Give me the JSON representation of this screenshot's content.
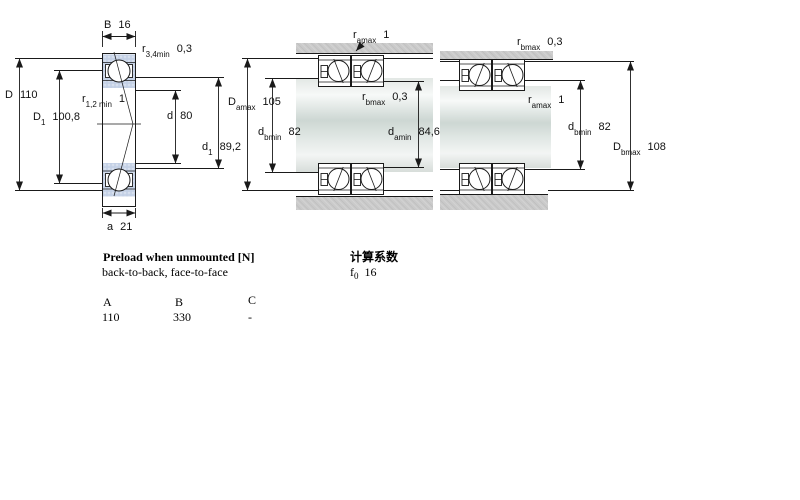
{
  "colors": {
    "line": "#1a1a1a",
    "ring_fill": "#c7d3e7",
    "housing_fill": "#cacaca",
    "shaft_light": "#f7f9f8",
    "shaft_dark": "#cdd7d3"
  },
  "left_diagram": {
    "B": {
      "base": "B",
      "sub": "",
      "value": "16"
    },
    "r34": {
      "base": "r",
      "sub": "3,4min",
      "value": "0,3"
    },
    "D": {
      "base": "D",
      "sub": "",
      "value": "110"
    },
    "D1": {
      "base": "D",
      "sub": "1",
      "value": "100,8"
    },
    "r12": {
      "base": "r",
      "sub": "1,2 min",
      "value": "1"
    },
    "d": {
      "base": "d",
      "sub": "",
      "value": "80"
    },
    "d1": {
      "base": "d",
      "sub": "1",
      "value": "89,2"
    },
    "a": {
      "base": "a",
      "sub": "",
      "value": "21"
    }
  },
  "middle_diagram": {
    "ramax": {
      "base": "r",
      "sub": "amax",
      "value": "1"
    },
    "Damax": {
      "base": "D",
      "sub": "amax",
      "value": "105"
    },
    "rbmax": {
      "base": "r",
      "sub": "bmax",
      "value": "0,3"
    },
    "dbmin": {
      "base": "d",
      "sub": "bmin",
      "value": "82"
    },
    "damin": {
      "base": "d",
      "sub": "amin",
      "value": "84,6"
    }
  },
  "right_diagram": {
    "rbmax": {
      "base": "r",
      "sub": "bmax",
      "value": "0,3"
    },
    "ramax": {
      "base": "r",
      "sub": "amax",
      "value": "1"
    },
    "dbmin": {
      "base": "d",
      "sub": "bmin",
      "value": "82"
    },
    "Dbmax": {
      "base": "D",
      "sub": "bmax",
      "value": "108"
    }
  },
  "notes": {
    "title": "Preload when unmounted [N]",
    "subtitle": "back-to-back, face-to-face",
    "cn_title": "计算系数",
    "f0": {
      "base": "f",
      "sub": "0",
      "value": "16"
    }
  },
  "table": {
    "headers": [
      "A",
      "B",
      "C"
    ],
    "values": [
      "110",
      "330",
      "-"
    ]
  }
}
